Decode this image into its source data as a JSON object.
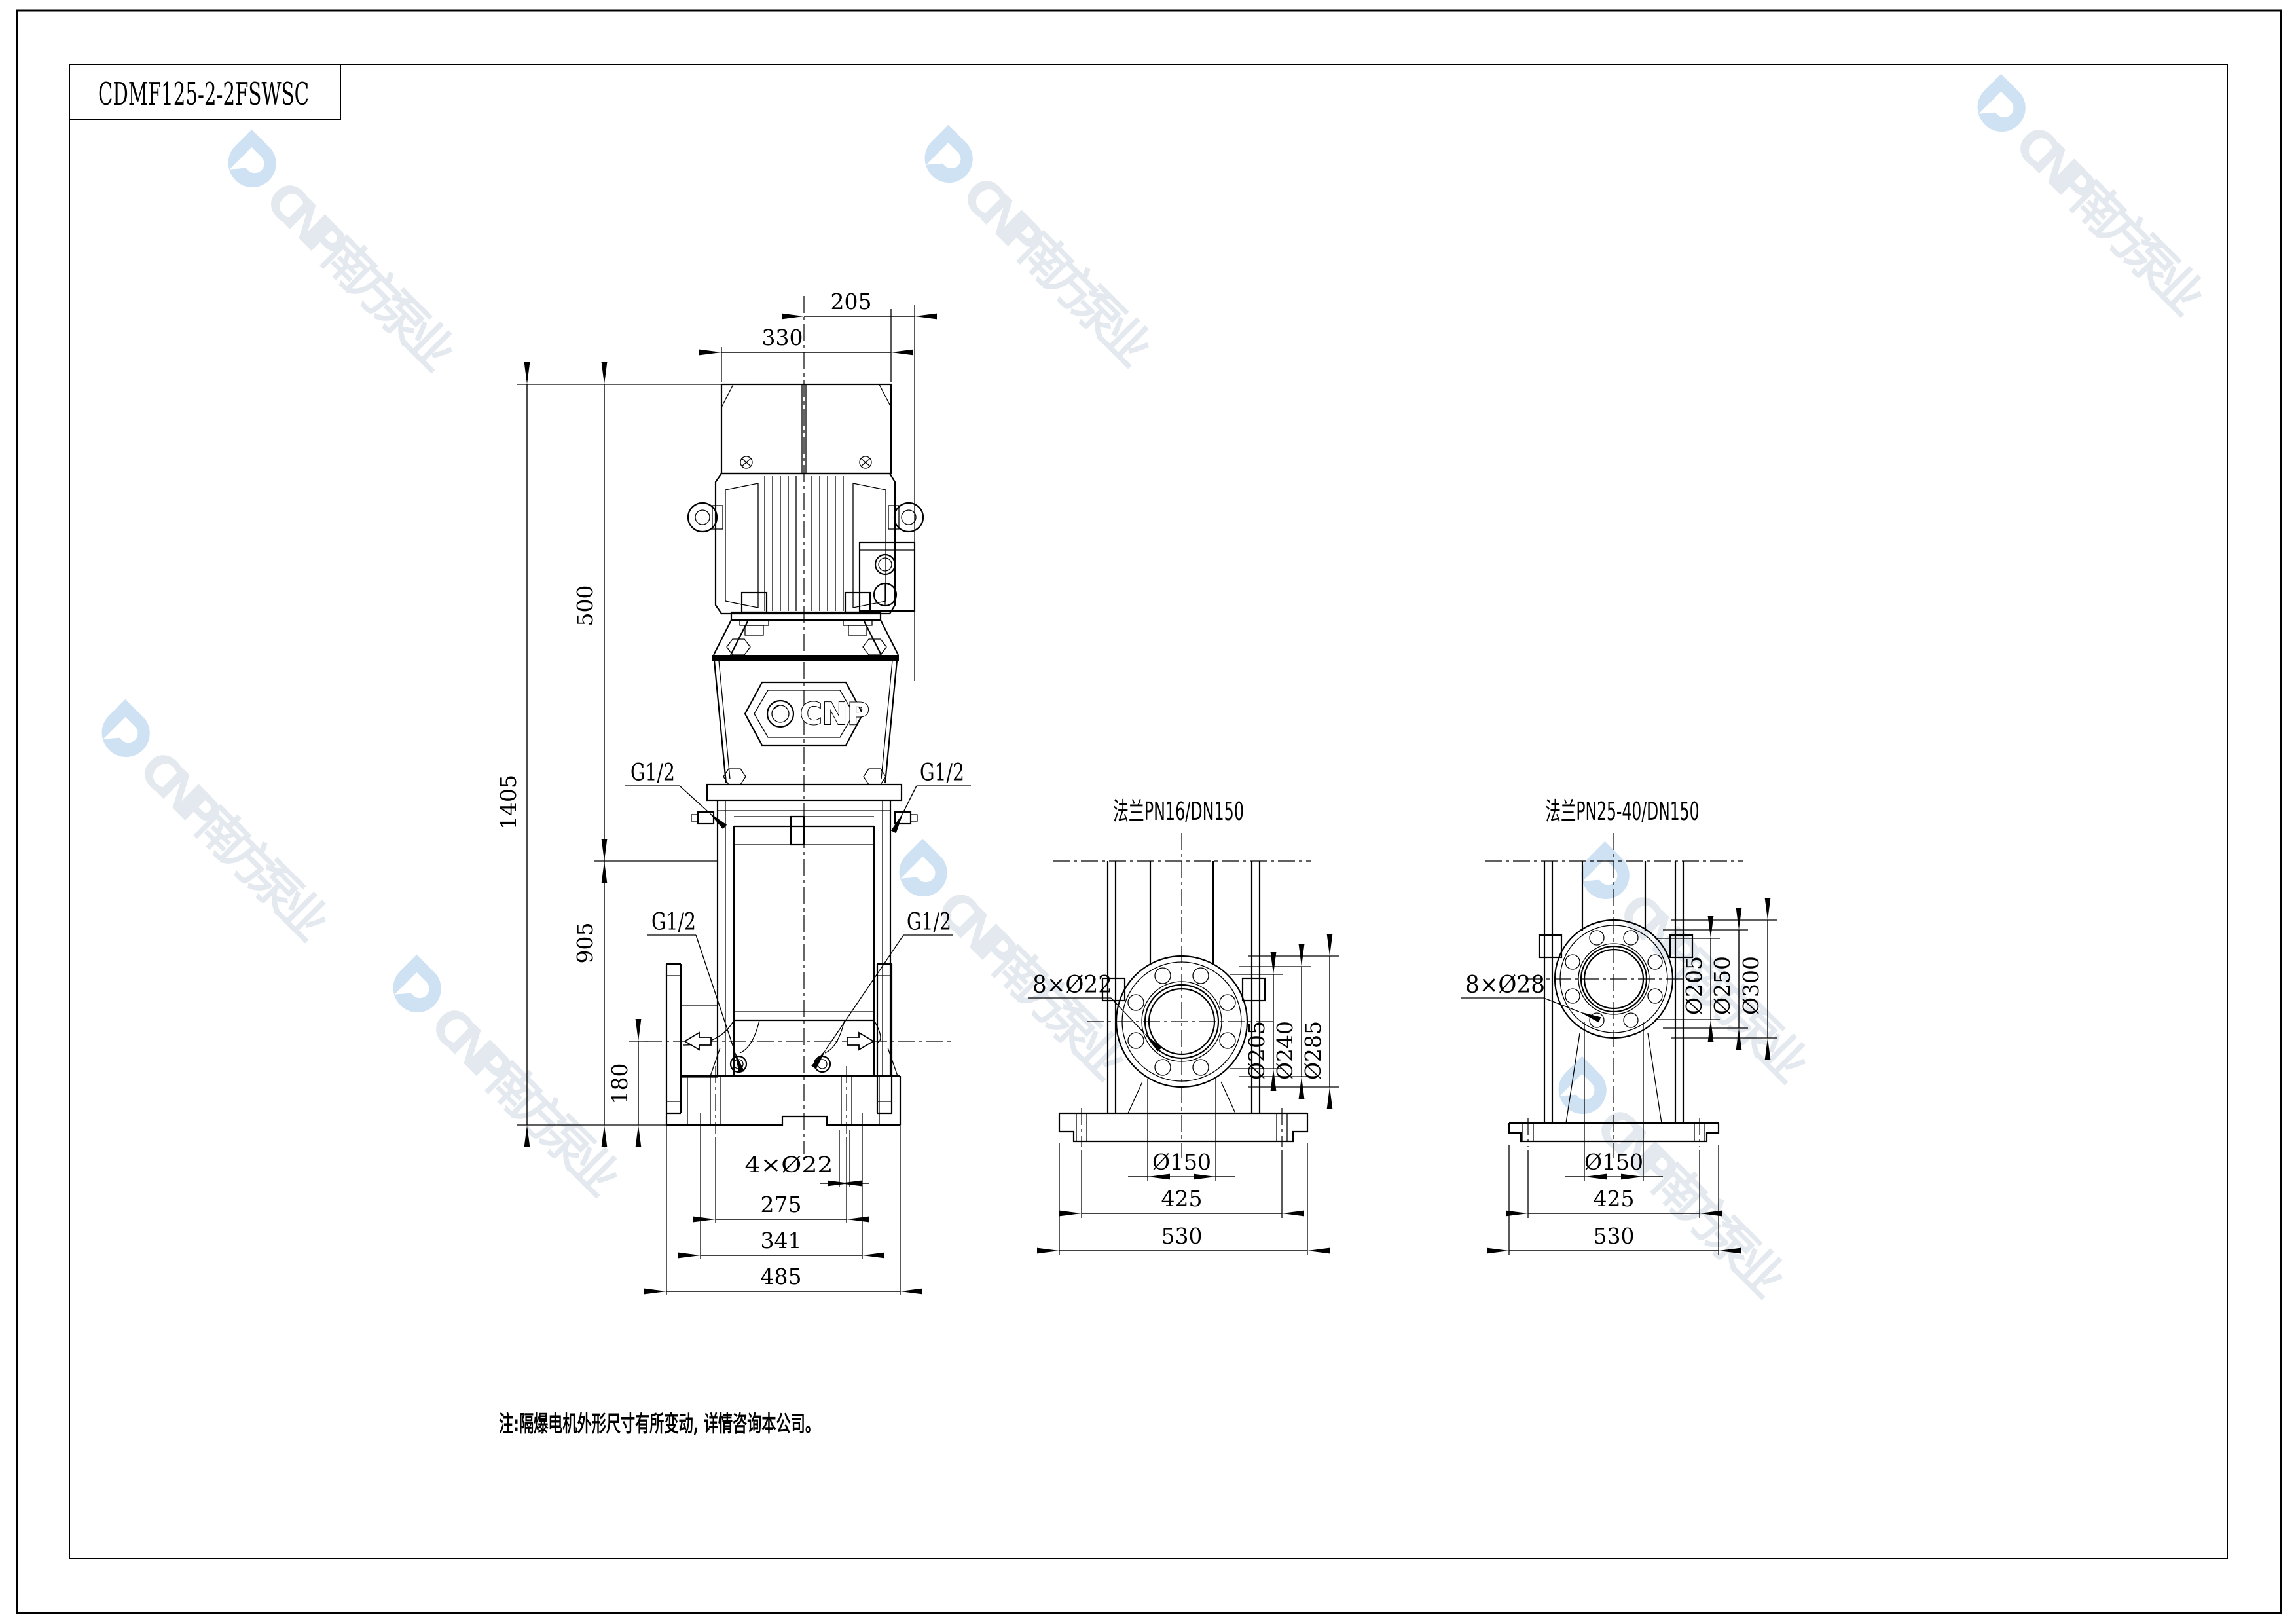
{
  "title_block": {
    "model": "CDMF125-2-2FSWSC"
  },
  "note": "注:隔爆电机外形尺寸有所变动, 详情咨询本公司。",
  "watermark": {
    "text": "CNP南方泵业",
    "logo_color": "#cfe2f4",
    "text_color": "#e3e9ee"
  },
  "front_view": {
    "badge": "CNP",
    "dims": {
      "top_offset": "205",
      "fan_width": "330",
      "motor_height": "500",
      "total_height": "1405",
      "pump_height": "905",
      "port_height": "180",
      "foundation_holes": "4×Ø22",
      "hole_spacing": "275",
      "base_mid_width": "341",
      "base_width": "485"
    },
    "ports": {
      "top_left": "G1/2",
      "top_right": "G1/2",
      "mid_left": "G1/2",
      "mid_right": "G1/2"
    }
  },
  "flange_pn16": {
    "title": "法兰PN16/DN150",
    "holes": "8×Ø22",
    "d_face": "Ø205",
    "d_bolt_circle": "Ø240",
    "d_outer": "Ø285",
    "d_bore": "Ø150",
    "bolt_span": "425",
    "base_width": "530"
  },
  "flange_pn25": {
    "title": "法兰PN25-40/DN150",
    "holes": "8×Ø28",
    "d_face": "Ø205",
    "d_bolt_circle": "Ø250",
    "d_outer": "Ø300",
    "d_bore": "Ø150",
    "bolt_span": "425",
    "base_width": "530"
  }
}
